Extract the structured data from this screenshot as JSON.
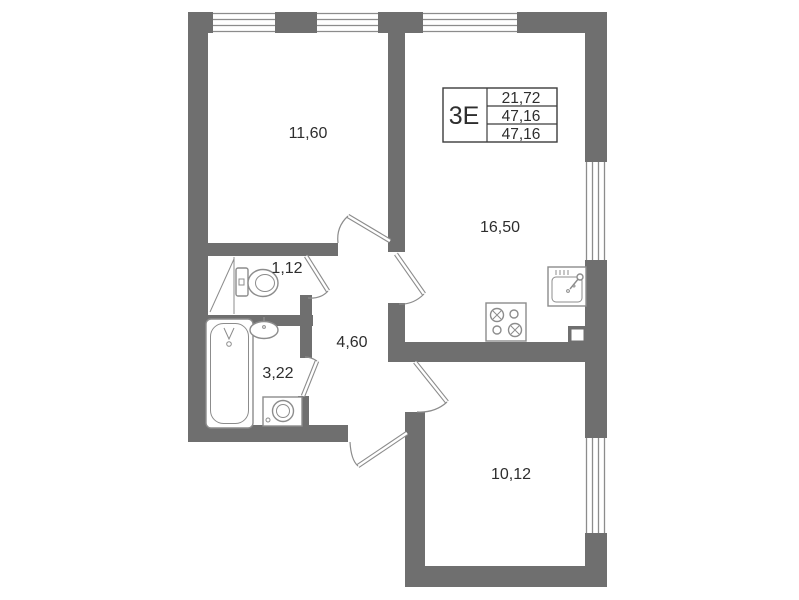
{
  "plan": {
    "info_box": {
      "unit_type": "3Е",
      "values": [
        "21,72",
        "47,16",
        "47,16"
      ]
    },
    "rooms": [
      {
        "name": "bedroom",
        "area": "11,60"
      },
      {
        "name": "kitchen-living",
        "area": "16,50"
      },
      {
        "name": "wc",
        "area": "1,12"
      },
      {
        "name": "bathroom",
        "area": "3,22"
      },
      {
        "name": "hall",
        "area": "4,60"
      },
      {
        "name": "room",
        "area": "10,12"
      }
    ],
    "fixtures": {
      "toilet": "toilet-icon",
      "bathtub": "bathtub-icon",
      "bath_sink": "sink-icon",
      "washing_machine": "washing-machine-icon",
      "stove": "stove-icon",
      "kitchen_sink": "kitchen-sink-icon",
      "vent_shaft": "vent-shaft-icon"
    },
    "colors": {
      "wall": "#6f6f6f",
      "line": "#8c8c8c",
      "fixture": "#8c8c8c",
      "text": "#2e2e2e",
      "table_border": "#3c3c3c",
      "bg": "#ffffff"
    }
  }
}
